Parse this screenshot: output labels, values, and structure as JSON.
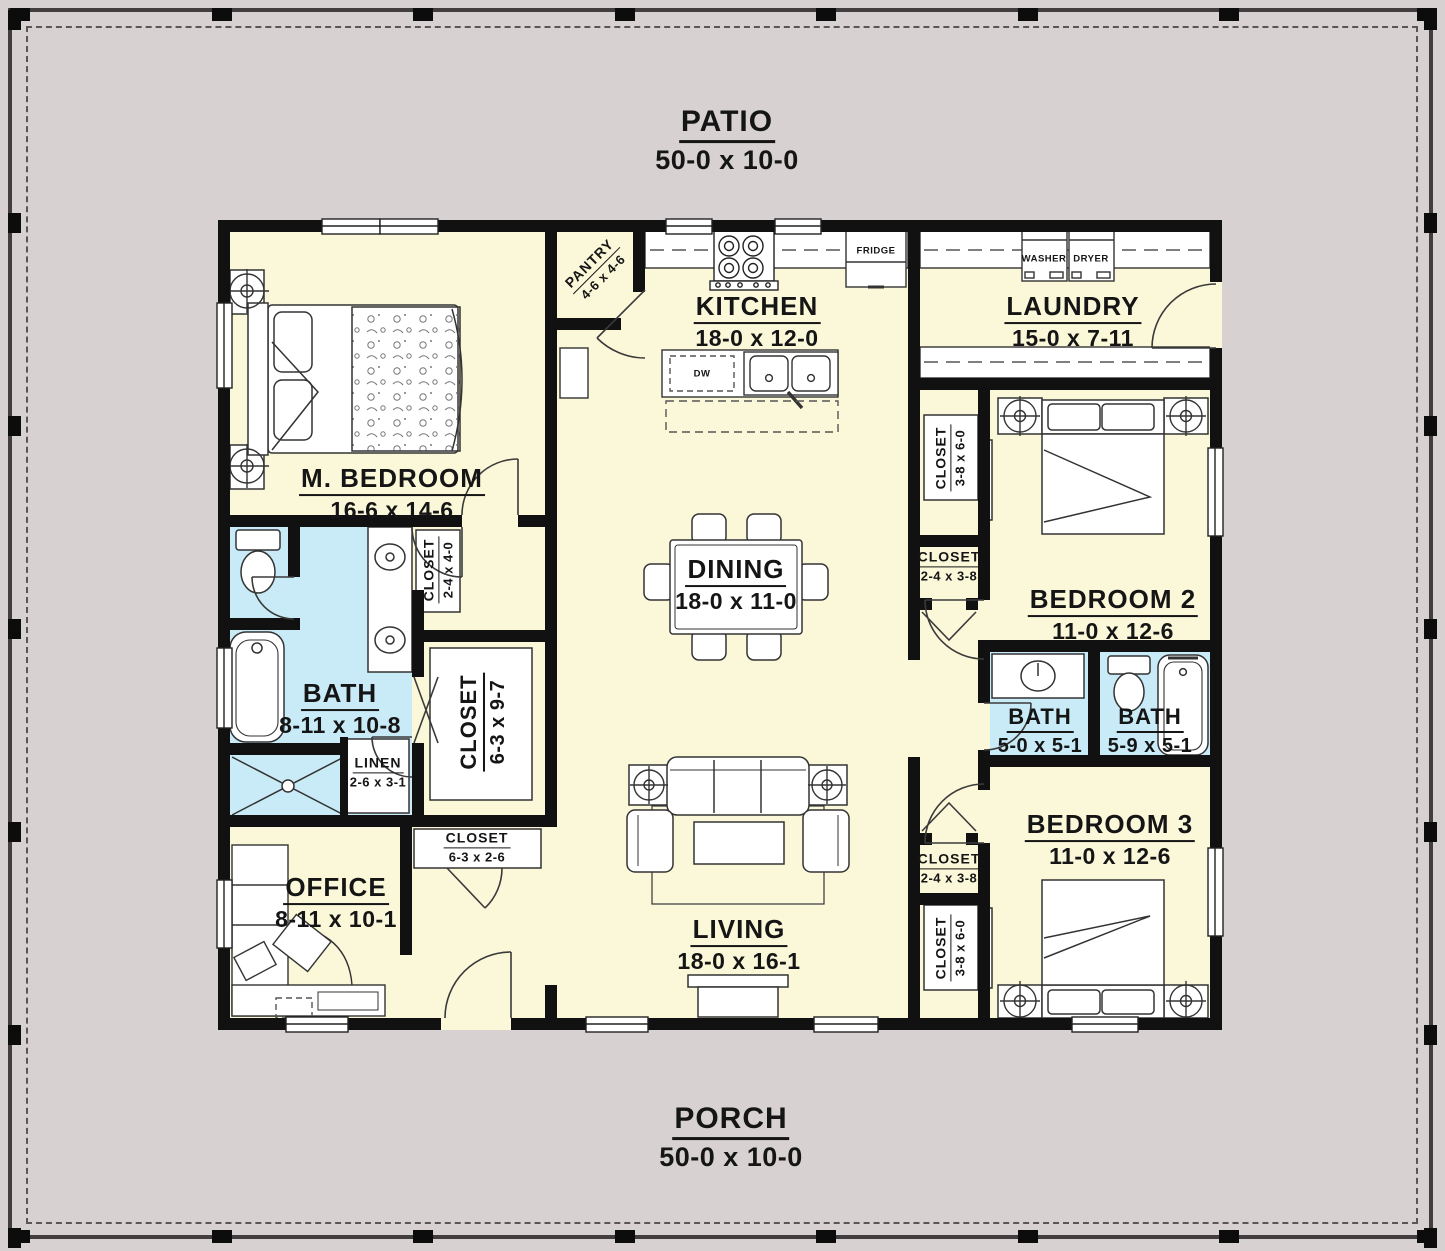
{
  "plan": {
    "patio": {
      "name": "PATIO",
      "dims": "50-0 x 10-0"
    },
    "porch": {
      "name": "PORCH",
      "dims": "50-0 x 10-0"
    },
    "rooms": {
      "master": {
        "name": "M. BEDROOM",
        "dims": "16-6 x 14-6"
      },
      "pantry": {
        "name": "PANTRY",
        "dims": "4-6 x 4-6"
      },
      "kitchen": {
        "name": "KITCHEN",
        "dims": "18-0 x 12-0"
      },
      "laundry": {
        "name": "LAUNDRY",
        "dims": "15-0 x 7-11"
      },
      "dining": {
        "name": "DINING",
        "dims": "18-0 x 11-0"
      },
      "living": {
        "name": "LIVING",
        "dims": "18-0 x 16-1"
      },
      "office": {
        "name": "OFFICE",
        "dims": "8-11 x 10-1"
      },
      "master_bath": {
        "name": "BATH",
        "dims": "8-11 x 10-8"
      },
      "master_closet": {
        "name": "CLOSET",
        "dims": "6-3 x 9-7"
      },
      "closet_2440": {
        "name": "CLOSET",
        "dims": "2-4 x 4-0"
      },
      "linen": {
        "name": "LINEN",
        "dims": "2-6 x 3-1"
      },
      "closet_6326": {
        "name": "CLOSET",
        "dims": "6-3 x 2-6"
      },
      "bedroom2": {
        "name": "BEDROOM 2",
        "dims": "11-0 x 12-6"
      },
      "bedroom3": {
        "name": "BEDROOM 3",
        "dims": "11-0 x 12-6"
      },
      "bath2": {
        "name": "BATH",
        "dims": "5-0 x 5-1"
      },
      "bath3": {
        "name": "BATH",
        "dims": "5-9 x 5-1"
      },
      "closet_3860_top": {
        "name": "CLOSET",
        "dims": "3-8 x 6-0"
      },
      "closet_2438_top": {
        "name": "CLOSET",
        "dims": "2-4 x 3-8"
      },
      "closet_2438_bottom": {
        "name": "CLOSET",
        "dims": "2-4 x 3-8"
      },
      "closet_3860_bottom": {
        "name": "CLOSET",
        "dims": "3-8 x 6-0"
      }
    },
    "appliances": {
      "fridge": "FRIDGE",
      "dishwasher": "DW",
      "washer": "WASHER",
      "dryer": "DRYER"
    },
    "colors": {
      "floor": "#FBF8DA",
      "bath": "#C9EBF7",
      "outdoor": "#D7D1D2",
      "wall": "#111111"
    }
  }
}
